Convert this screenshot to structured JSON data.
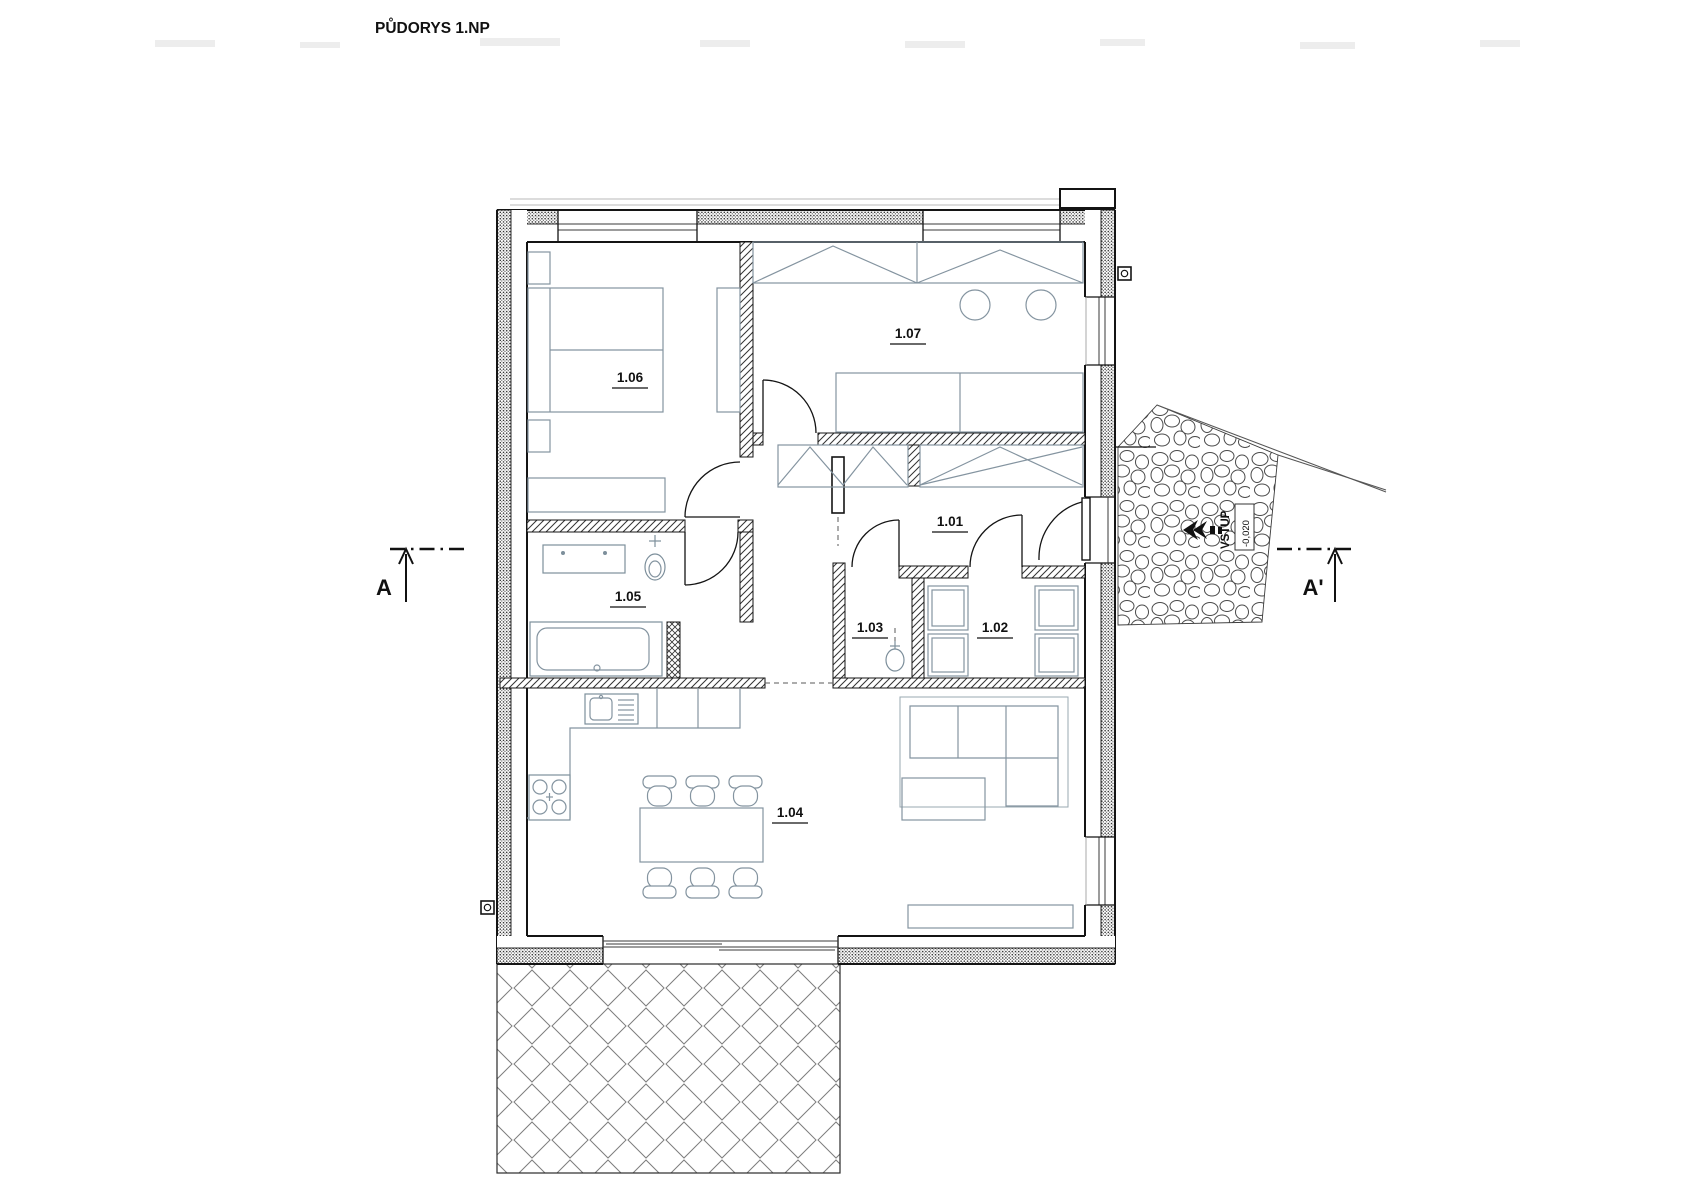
{
  "title": "PŮDORYS 1.NP",
  "rooms": {
    "r101": {
      "label": "1.01"
    },
    "r102": {
      "label": "1.02"
    },
    "r103": {
      "label": "1.03"
    },
    "r104": {
      "label": "1.04"
    },
    "r105": {
      "label": "1.05"
    },
    "r106": {
      "label": "1.06"
    },
    "r107": {
      "label": "1.07"
    }
  },
  "section_markers": {
    "left": "A",
    "right": "A'"
  },
  "entrance": {
    "label": "VSTUP",
    "level": "-0,020"
  },
  "colors": {
    "walls": "#141414",
    "furniture": "#8494a0",
    "stones_outline": "#4a4a4a",
    "paper": "#ffffff"
  }
}
